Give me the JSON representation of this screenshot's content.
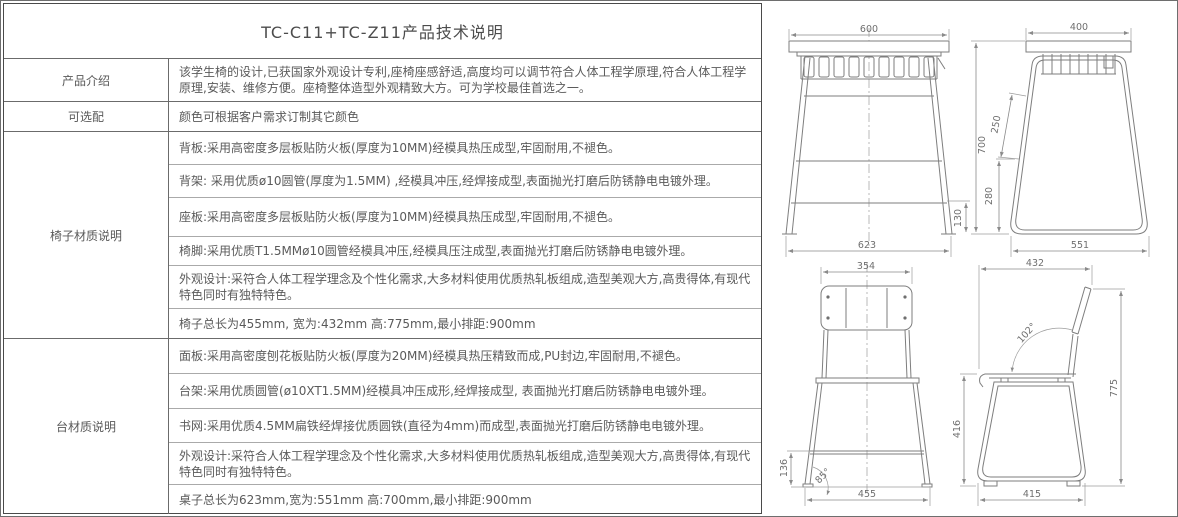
{
  "title": "TC-C11+TC-Z11产品技术说明",
  "table": {
    "sections": [
      {
        "label": "产品介绍",
        "rows": [
          "该学生椅的设计,已获国家外观设计专利,座椅座感舒适,高度均可以调节符合人体工程学原理,符合人体工程学原理,安装、维修方便。座椅整体造型外观精致大方。可为学校最佳首选之一。"
        ]
      },
      {
        "label": "可选配",
        "rows": [
          "颜色可根据客户需求订制其它颜色"
        ]
      },
      {
        "label": "椅子材质说明",
        "rows": [
          "背板:采用高密度多层板贴防火板(厚度为10MM)经模具热压成型,牢固耐用,不褪色。",
          "背架: 采用优质ø10圆管(厚度为1.5MM) ,经模具冲压,经焊接成型,表面抛光打磨后防锈静电电镀外理。",
          "座板:采用高密度多层板贴防火板(厚度为10MM)经模具热压成型,牢固耐用,不褪色。",
          "椅脚:采用优质T1.5MMø10圆管经模具冲压,经模具压注成型,表面抛光打磨后防锈静电电镀外理。",
          "外观设计:采符合人体工程学理念及个性化需求,大多材料使用优质热轧板组成,造型美观大方,高贵得体,有现代特色同时有独特特色。",
          "椅子总长为455mm, 宽为:432mm  高:775mm,最小排距:900mm"
        ]
      },
      {
        "label": "台材质说明",
        "rows": [
          "面板:采用高密度刨花板贴防火板(厚度为20MM)经模具热压精致而成,PU封边,牢固耐用,不褪色。",
          "台架:采用优质圆管(ø10XT1.5MM)经模具冲压成形,经焊接成型, 表面抛光打磨后防锈静电电镀外理。",
          "书网:采用优质4.5MM扁铁经焊接优质圆铁(直径为4mm)而成型,表面抛光打磨后防锈静电电镀外理。",
          "外观设计:采符合人体工程学理念及个性化需求,大多材料使用优质热轧板组成,造型美观大方,高贵得体,有现代特色同时有独特特色。",
          "桌子总长为623mm,宽为:551mm  高:700mm,最小排距:900mm"
        ]
      }
    ]
  },
  "drawings": {
    "desk_front": {
      "top": "600",
      "right": "130",
      "bottom": "623"
    },
    "desk_side": {
      "top": "400",
      "height": "700",
      "upper": "250",
      "lower": "280",
      "bottom": "551"
    },
    "chair_back": {
      "top": "354",
      "left": "136",
      "angle": "85°",
      "bottom": "455"
    },
    "chair_side": {
      "top": "432",
      "angle": "102°",
      "height": "775",
      "seat": "416",
      "bottom": "415"
    }
  },
  "colors": {
    "line": "#7e7e7e",
    "text": "#595959",
    "border": "#6b6b6b"
  }
}
